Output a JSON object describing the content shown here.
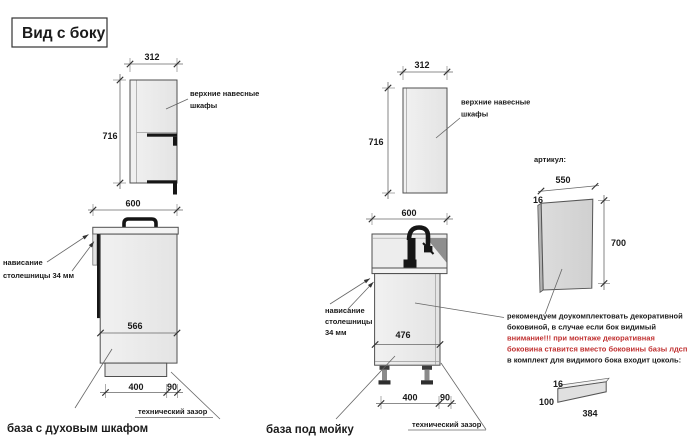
{
  "title": "Вид с боку",
  "left_view": {
    "upper_cabinet": {
      "width": "312",
      "height": "716",
      "label_line1": "верхние навесные",
      "label_line2": "шкафы"
    },
    "base_cabinet": {
      "width": "600",
      "inner_height": "566",
      "plinth_depth": "400",
      "tech_gap": "90",
      "overhang_line1": "нависание",
      "overhang_line2": "столешницы 34 мм",
      "tech_gap_note": "технический зазор",
      "caption": "база с духовым шкафом"
    }
  },
  "middle_view": {
    "upper_cabinet": {
      "width": "312",
      "height": "716",
      "label_line1": "верхние навесные",
      "label_line2": "шкафы"
    },
    "base_cabinet": {
      "width": "600",
      "inner_height": "476",
      "plinth_depth": "400",
      "tech_gap": "90",
      "overhang_line1": "нависание",
      "overhang_line2": "столешницы",
      "overhang_line3": "34 мм",
      "tech_gap_note": "технический зазор",
      "caption": "база под мойку"
    }
  },
  "right_view": {
    "artikul_label": "артикул:",
    "decor_panel": {
      "width": "550",
      "thickness": "16",
      "height": "700"
    },
    "notes": {
      "line1": "рекомендуем доукомплектовать декоративной",
      "line2": "боковиной, в случае если бок видимый",
      "line3": "внимание!!! при монтаже декоративная",
      "line4": "боковина ставится вместо боковины базы лдсп",
      "line5": "в комплект для видимого бока входит цоколь:"
    },
    "plinth_piece": {
      "thickness": "16",
      "height": "100",
      "length": "384"
    }
  },
  "colors": {
    "warning_red": "#c03030",
    "cabinet_fill": "#ededed",
    "panel_fill": "#d8d8d8",
    "dark_parts": "#161616"
  }
}
